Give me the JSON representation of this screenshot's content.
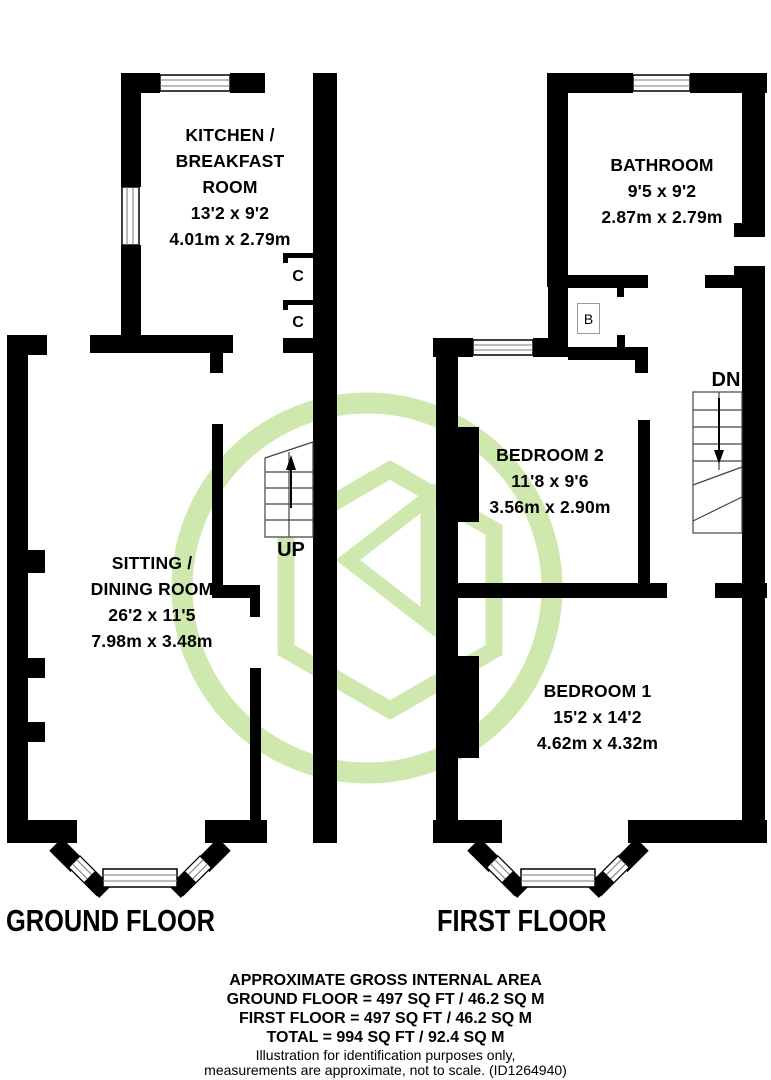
{
  "watermark": {
    "color": "#cfe8ad"
  },
  "walls_color": "#000000",
  "ground_floor": {
    "title": "GROUND FLOOR",
    "rooms": {
      "kitchen": {
        "lines": [
          "KITCHEN /",
          "BREAKFAST",
          "ROOM"
        ],
        "size_ft": "13'2 x 9'2",
        "size_m": "4.01m x 2.79m"
      },
      "sitting": {
        "lines": [
          "SITTING /",
          "DINING ROOM"
        ],
        "size_ft": "26'2 x 11'5",
        "size_m": "7.98m x 3.48m"
      }
    },
    "labels": {
      "up": "UP",
      "closet1": "C",
      "closet2": "C"
    }
  },
  "first_floor": {
    "title": "FIRST FLOOR",
    "rooms": {
      "bathroom": {
        "name": "BATHROOM",
        "size_ft": "9'5 x 9'2",
        "size_m": "2.87m x 2.79m"
      },
      "bedroom2": {
        "name": "BEDROOM 2",
        "size_ft": "11'8 x 9'6",
        "size_m": "3.56m x 2.90m"
      },
      "bedroom1": {
        "name": "BEDROOM 1",
        "size_ft": "15'2 x 14'2",
        "size_m": "4.62m x 4.32m"
      }
    },
    "labels": {
      "dn": "DN",
      "boiler": "B"
    }
  },
  "footer": {
    "title": "APPROXIMATE GROSS INTERNAL AREA",
    "ground_area": "GROUND FLOOR = 497 SQ FT / 46.2 SQ M",
    "first_area": "FIRST FLOOR = 497 SQ FT / 46.2 SQ M",
    "total_area": "TOTAL = 994 SQ FT / 92.4 SQ M",
    "disclaimer1": "Illustration for identification purposes only,",
    "disclaimer2": "measurements are approximate, not to scale. (ID1264940)"
  }
}
